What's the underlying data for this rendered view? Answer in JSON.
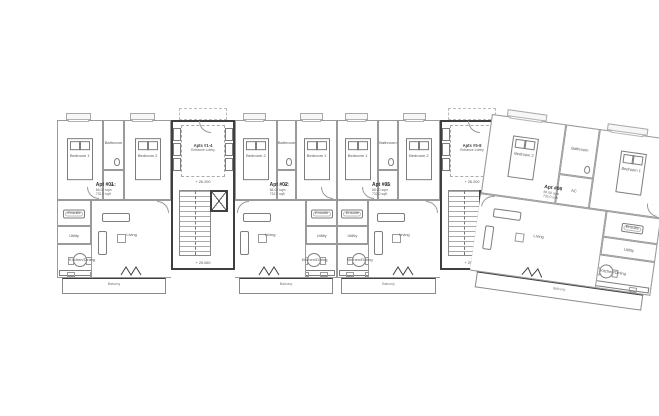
{
  "plan": {
    "units": [
      {
        "label": "Apt #01",
        "area_sqm": "68.00 sqm",
        "area_sqft": "732.0 sqft",
        "rooms": {
          "bedroom1": "Bedroom 1",
          "bedroom2": "Bedroom 2",
          "bathroom": "Bathroom",
          "ac": "AC",
          "ensuite": "Ensuite",
          "utility": "Utility",
          "kitchen": "Kitchen/Dining",
          "living": "Living",
          "balcony": "Balcony"
        }
      },
      {
        "label": "Apt #02",
        "area_sqm": "68.00 sqm",
        "area_sqft": "732.0 sqft",
        "rooms": {
          "bedroom1": "Bedroom 1",
          "bedroom2": "Bedroom 2",
          "bathroom": "Bathroom",
          "ac": "AC",
          "ensuite": "Ensuite",
          "utility": "Utility",
          "kitchen": "Kitchen/Dining",
          "living": "Living",
          "balcony": "Balcony"
        }
      },
      {
        "label": "Apt #05",
        "area_sqm": "68.00 sqm",
        "area_sqft": "732.0 sqft",
        "rooms": {
          "bedroom1": "Bedroom 1",
          "bedroom2": "Bedroom 2",
          "bathroom": "Bathroom",
          "ac": "AC",
          "ensuite": "Ensuite",
          "utility": "Utility",
          "kitchen": "Kitchen/Dining",
          "living": "Living",
          "balcony": "Balcony"
        }
      },
      {
        "label": "Apt #06",
        "area_sqm": "68.00 sqm",
        "area_sqft": "732.0 sqft",
        "rooms": {
          "bedroom1": "Bedroom 1",
          "bedroom2": "Bedroom 2",
          "bathroom": "Bathroom",
          "ac": "AC",
          "ensuite": "Ensuite",
          "utility": "Utility",
          "kitchen": "Kitchen/Dining",
          "living": "Living",
          "balcony": "Balcony"
        }
      }
    ],
    "cores": [
      {
        "label": "Apts #1-4",
        "sublabel": "Entrance Lobby",
        "upper_level": "+ 26.200",
        "lower_level": "+ 25.060"
      },
      {
        "label": "Apts #5-8",
        "sublabel": "Entrance Lobby",
        "upper_level": "+ 26.200",
        "lower_level": "+ 25.060"
      }
    ]
  }
}
